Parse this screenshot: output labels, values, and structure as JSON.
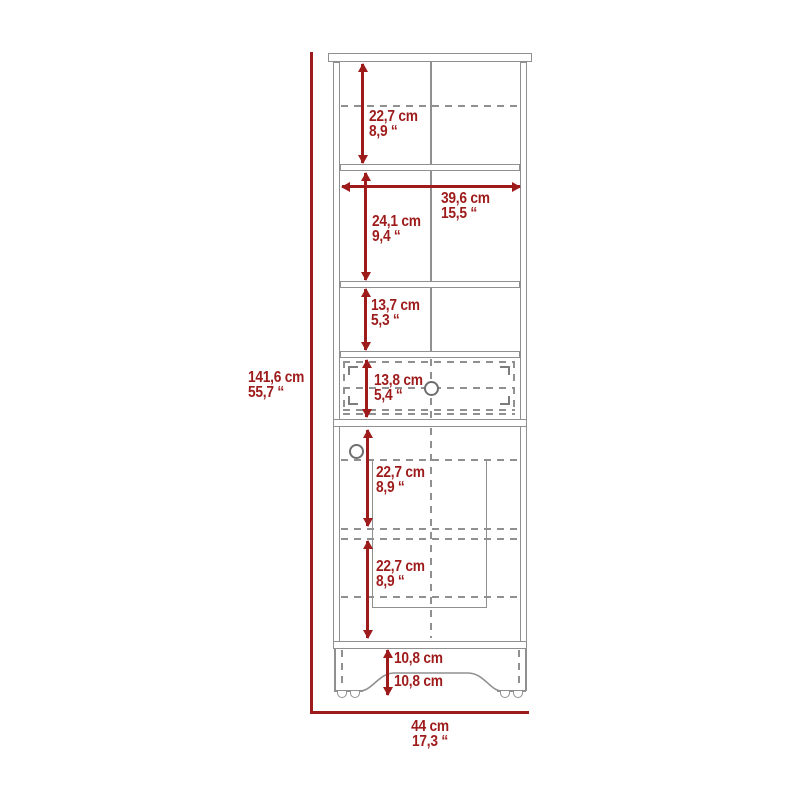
{
  "diagram_type": "furniture-dimension-drawing",
  "colors": {
    "dimension_red": "#9e1b1b",
    "outline_gray": "#909090",
    "background": "#ffffff"
  },
  "labels": {
    "overall_height": {
      "cm": "141,6 cm",
      "in": "55,7 “"
    },
    "overall_width": {
      "cm": "44 cm",
      "in": "17,3 “"
    },
    "top_section_height": {
      "cm": "22,7 cm",
      "in": "8,9 “"
    },
    "interior_width": {
      "cm": "39,6 cm",
      "in": "15,5 “"
    },
    "second_section_height": {
      "cm": "24,1 cm",
      "in": "9,4 “"
    },
    "third_section_height": {
      "cm": "13,7 cm",
      "in": "5,3 “"
    },
    "drawer_height": {
      "cm": "13,8 cm",
      "in": "5,4 “"
    },
    "door_upper_height": {
      "cm": "22,7 cm",
      "in": "8,9 “"
    },
    "door_lower_height": {
      "cm": "22,7 cm",
      "in": "8,9 “"
    },
    "base_front_height": {
      "cm": "10,8 cm"
    },
    "base_back_height": {
      "cm": "10,8 cm"
    }
  }
}
